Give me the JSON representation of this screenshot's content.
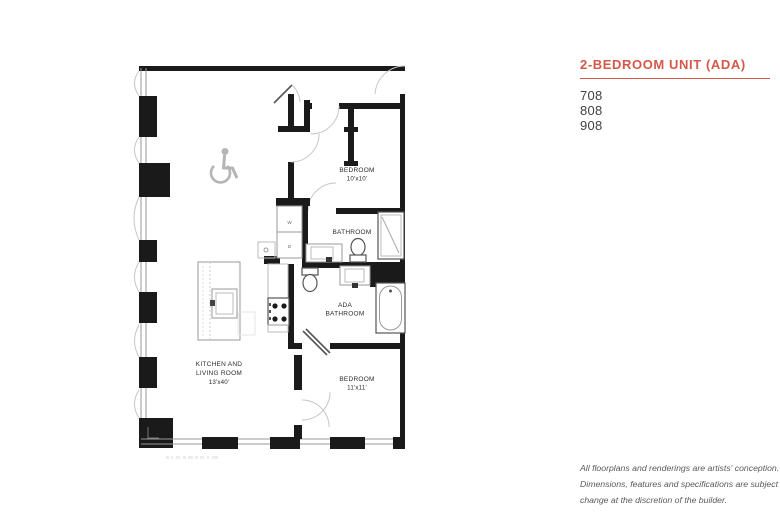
{
  "panel": {
    "title": "2-BEDROOM UNIT (ADA)",
    "units": [
      "708",
      "808",
      "908"
    ],
    "disclaimer": [
      "All floorplans and renderings are artists' conception.",
      "Dimensions, features and specifications are subject to",
      "change at the discretion of the builder."
    ]
  },
  "floorplan": {
    "labels": {
      "bedroom1_name": "BEDROOM",
      "bedroom1_dims": "10'x10'",
      "bathroom_name": "BATHROOM",
      "ada_line1": "ADA",
      "ada_line2": "BATHROOM",
      "kitchen_line1": "KITCHEN AND",
      "kitchen_line2": "LIVING ROOM",
      "kitchen_dims": "13'x40'",
      "bedroom2_name": "BEDROOM",
      "bedroom2_dims": "11'x11'",
      "washer": "W",
      "dryer": "D"
    },
    "icons": {
      "accessible": "wheelchair-icon"
    }
  },
  "colors": {
    "accent": "#d2594a",
    "text_dark": "#414042",
    "text_muted": "#58595b",
    "wall": "#1a1a1a",
    "accessible_icon": "#b5b5b5",
    "background": "#ffffff"
  }
}
